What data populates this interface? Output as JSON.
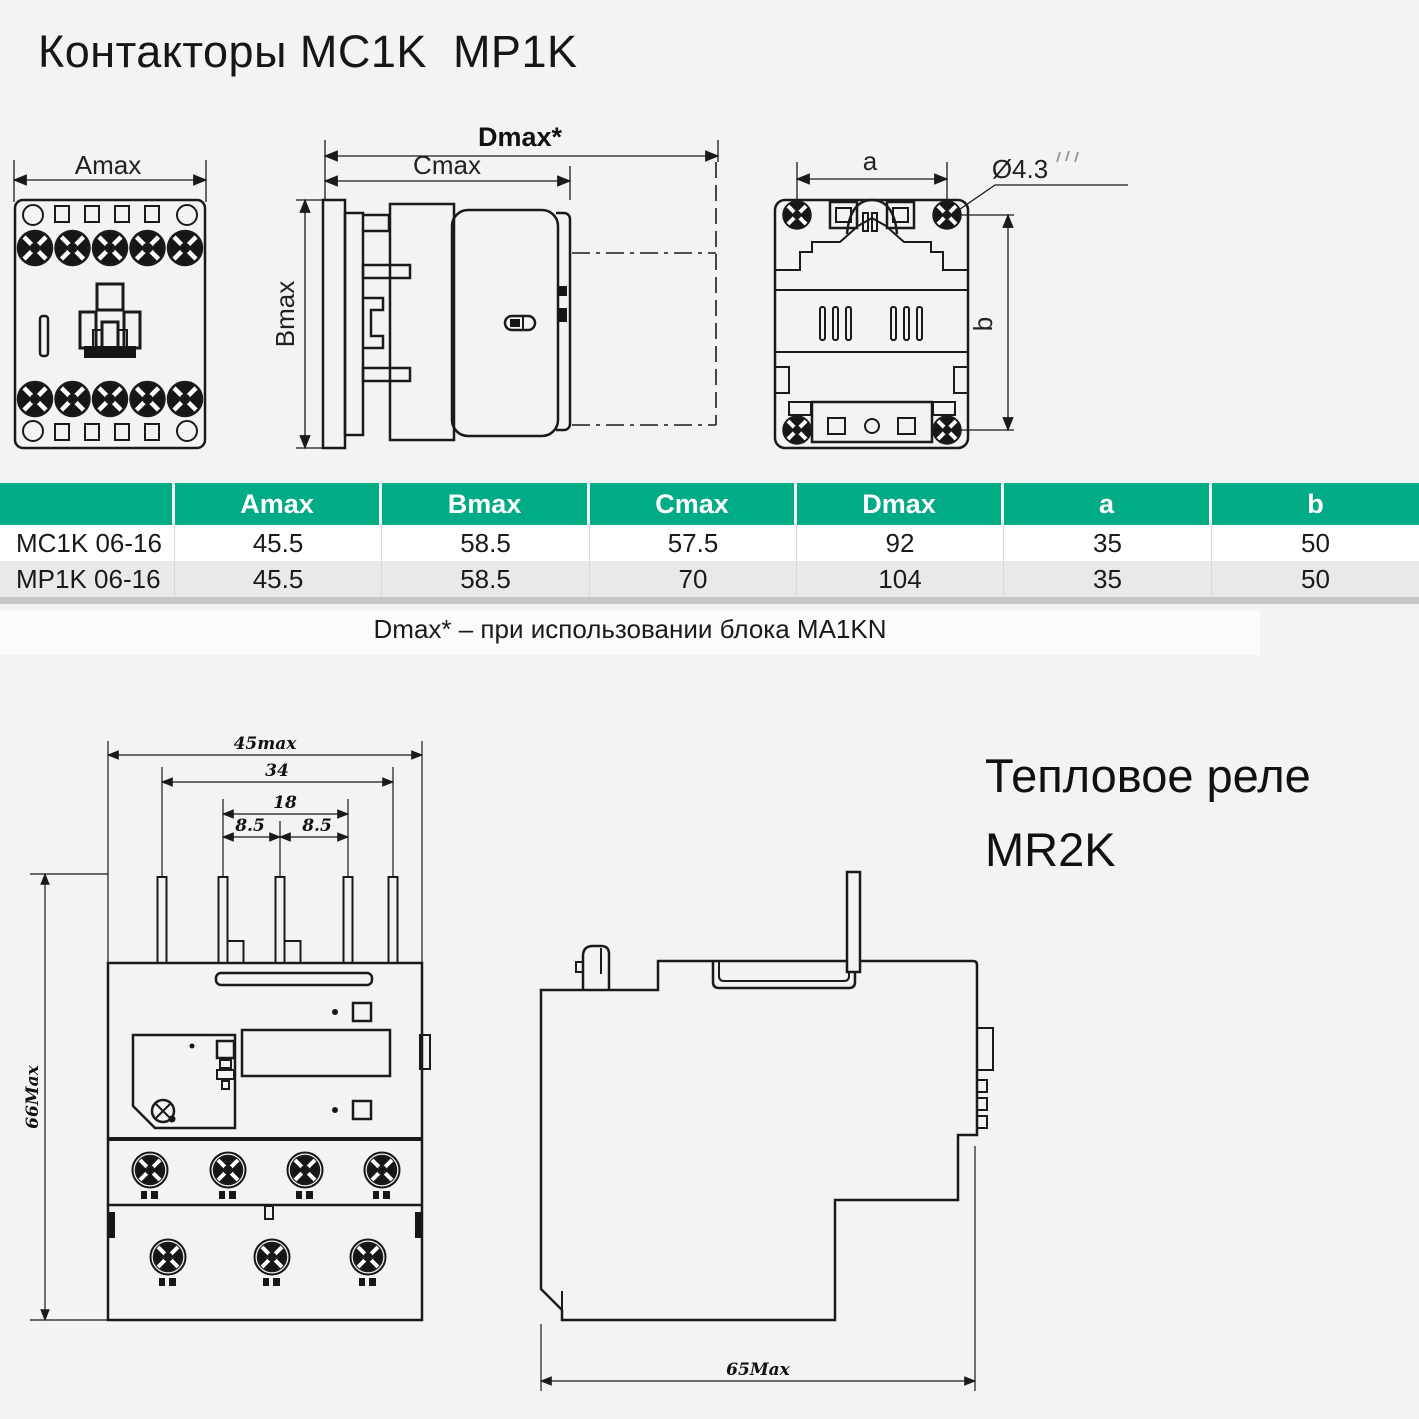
{
  "page": {
    "bg": "#f3f3f3",
    "ink": "#1a1a1a"
  },
  "contactors": {
    "title": "Контакторы MC1K  MP1K",
    "drawings": {
      "front": {
        "amax": "Amax"
      },
      "side": {
        "dmax": "Dmax*",
        "cmax": "Cmax",
        "bmax": "Bmax"
      },
      "back": {
        "a": "a",
        "hole": "Ø4.3",
        "b": "b"
      }
    },
    "table": {
      "header_bg": "#00ab85",
      "row_alt_bg": "#e9e9e9",
      "header": [
        "",
        "Amax",
        "Bmax",
        "Cmax",
        "Dmax",
        "a",
        "b"
      ],
      "rows": [
        {
          "name": "MC1K 06-16",
          "values": [
            "45.5",
            "58.5",
            "57.5",
            "92",
            "35",
            "50"
          ]
        },
        {
          "name": "MP1K 06-16",
          "values": [
            "45.5",
            "58.5",
            "70",
            "104",
            "35",
            "50"
          ]
        }
      ]
    },
    "note": "Dmax* – при использовании блока MA1KN"
  },
  "relay": {
    "title_line1": "Тепловое реле",
    "title_line2": "MR2K",
    "front": {
      "d45": "45max",
      "d34": "34",
      "d18": "18",
      "d85a": "8.5",
      "d85b": "8.5",
      "d66": "66Max"
    },
    "side": {
      "d65": "65Max"
    }
  }
}
